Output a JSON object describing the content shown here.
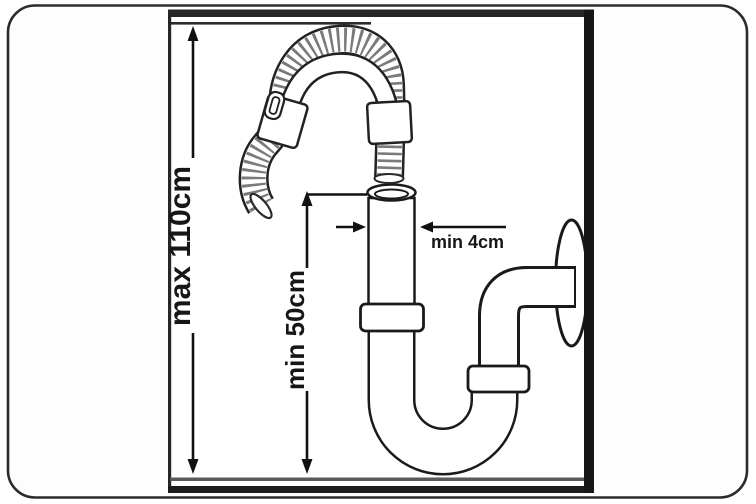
{
  "diagram": {
    "subject": "drain-hose-installation-diagram",
    "labels": {
      "max_height": "max 110cm",
      "min_height": "min 50cm",
      "min_diameter": "min 4cm"
    },
    "colors": {
      "outline": "#1a1a1a",
      "hose_rib": "#7a7a7a",
      "floor_line": "#5a5a5a",
      "wall_border": "#161616",
      "background": "#ffffff"
    }
  }
}
